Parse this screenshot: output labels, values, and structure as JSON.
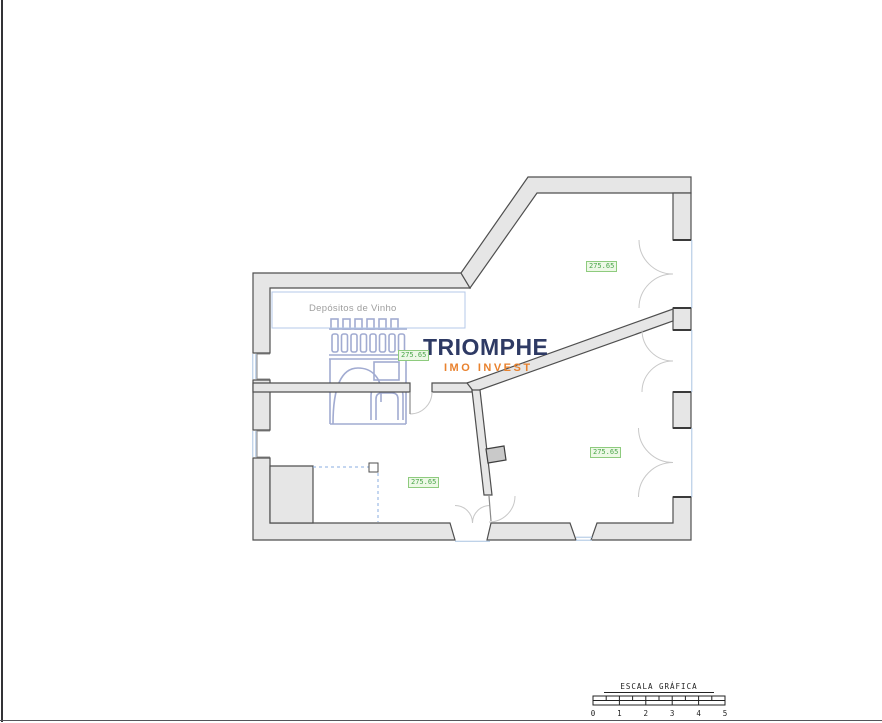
{
  "floor_plan": {
    "room_label": "Depósitos de Vinho",
    "elevation_labels": [
      "275.65",
      "275.65",
      "275.65",
      "275.65"
    ]
  },
  "logo": {
    "name": "TRIOMPHE",
    "tagline": "IMO INVEST"
  },
  "scale_bar": {
    "title": "ESCALA GRÁFICA",
    "tick_labels": [
      "0",
      "1",
      "2",
      "3",
      "4",
      "5"
    ]
  },
  "colors": {
    "wall_fill": "#e6e6e6",
    "wall_stroke": "#4f4f4f",
    "logo_navy": "#2e3a64",
    "logo_orange": "#e9822e",
    "logo_drawing_blue": "#9aa4ce",
    "elevation_green": "#4aa64a",
    "glazing_blue": "#a9c3e1"
  }
}
